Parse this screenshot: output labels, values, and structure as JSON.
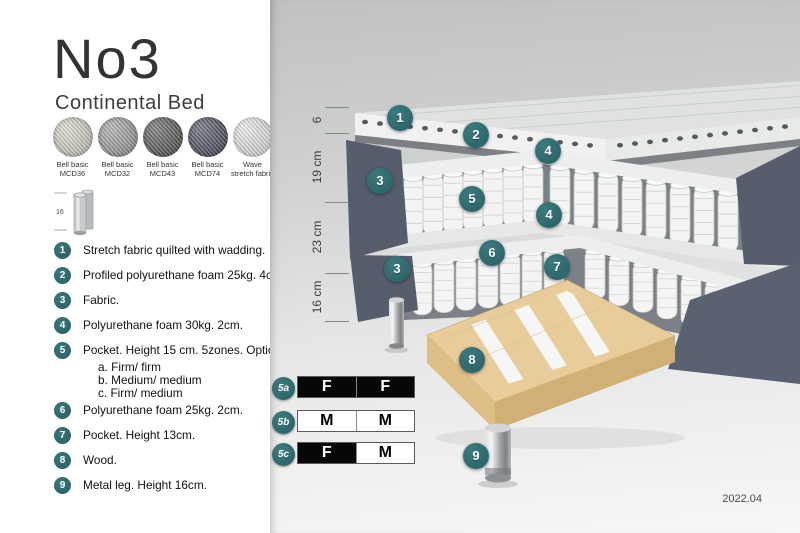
{
  "header": {
    "title": "No3",
    "subtitle": "Continental Bed"
  },
  "swatches": [
    {
      "name": "Bell basic MCD36",
      "line1": "Bell basic",
      "line2": "MCD36",
      "color": "#d8d3c9"
    },
    {
      "name": "Bell basic MCD32",
      "line1": "Bell basic",
      "line2": "MCD32",
      "color": "#999a98"
    },
    {
      "name": "Bell basic MCD43",
      "line1": "Bell basic",
      "line2": "MCD43",
      "color": "#4c4c4a"
    },
    {
      "name": "Bell basic MCD74",
      "line1": "Bell basic",
      "line2": "MCD74",
      "color": "#3c4156"
    },
    {
      "name": "Wave stretch fabric",
      "line1": "Wave",
      "line2": "stretch fabric",
      "color": "#e9eaea"
    }
  ],
  "leg_icon": {
    "height_label": "16"
  },
  "spec_list": [
    {
      "num": "1",
      "text": "Stretch fabric quilted with wadding."
    },
    {
      "num": "2",
      "text": "Profiled polyurethane foam 25kg. 4cm."
    },
    {
      "num": "3",
      "text": "Fabric."
    },
    {
      "num": "4",
      "text": "Polyurethane foam 30kg. 2cm."
    },
    {
      "num": "5",
      "text": "Pocket. Height 15 cm. 5zones. Option:",
      "options": [
        "a. Firm/ firm",
        "b. Medium/ medium",
        "c. Firm/ medium"
      ]
    },
    {
      "num": "6",
      "text": "Polyurethane foam 25kg. 2cm."
    },
    {
      "num": "7",
      "text": "Pocket. Height 13cm."
    },
    {
      "num": "8",
      "text": "Wood."
    },
    {
      "num": "9",
      "text": "Metal leg. Height 16cm."
    }
  ],
  "diagram": {
    "measurements": [
      {
        "label": "6"
      },
      {
        "label": "19 cm"
      },
      {
        "label": "23 cm"
      },
      {
        "label": "16 cm"
      }
    ],
    "callouts": [
      {
        "n": "1"
      },
      {
        "n": "2"
      },
      {
        "n": "4"
      },
      {
        "n": "3"
      },
      {
        "n": "5"
      },
      {
        "n": "4"
      },
      {
        "n": "6"
      },
      {
        "n": "7"
      },
      {
        "n": "3"
      },
      {
        "n": "8"
      },
      {
        "n": "9"
      }
    ],
    "firmness_table": [
      {
        "label": "5a",
        "cells": [
          "F",
          "F"
        ]
      },
      {
        "label": "5b",
        "cells": [
          "M",
          "M"
        ]
      },
      {
        "label": "5c",
        "cells": [
          "F",
          "M"
        ]
      }
    ],
    "version": "2022.04"
  },
  "colors": {
    "accent_teal": "#2d686d",
    "fabric_dark": "#565d6b",
    "wood": "#e8cd9b",
    "panel_bg_top": "#c0c2c1",
    "panel_bg_bottom": "#f7f7f6"
  }
}
